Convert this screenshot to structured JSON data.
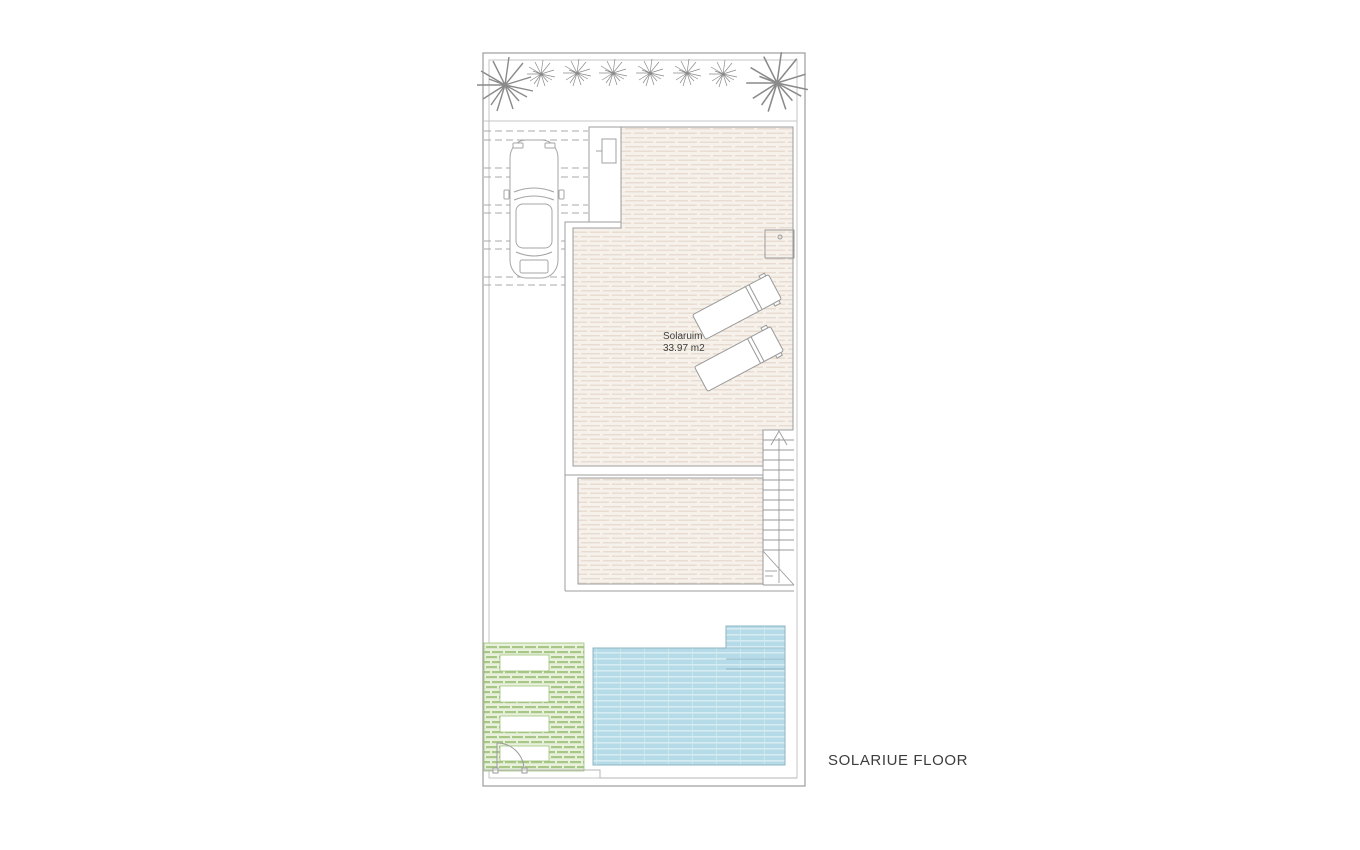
{
  "title": "SOLARIUE FLOOR",
  "solarium_label": {
    "name": "Solaruim",
    "area": "33.97 m2"
  },
  "colors": {
    "outline": "#9c9c9c",
    "fence": "#c6c6c6",
    "deck_fill": "#f6f1ea",
    "deck_stripe": "#e8dbd0",
    "pool_fill": "#b5dbe9",
    "pool_stripe": "#d6ecf2",
    "pool_edge": "#8fb6c4",
    "grass_fill": "#e9f1dd",
    "grass_stripe": "#a6c785",
    "grass_edge": "#9dc178",
    "label": "#3d3d3d"
  }
}
